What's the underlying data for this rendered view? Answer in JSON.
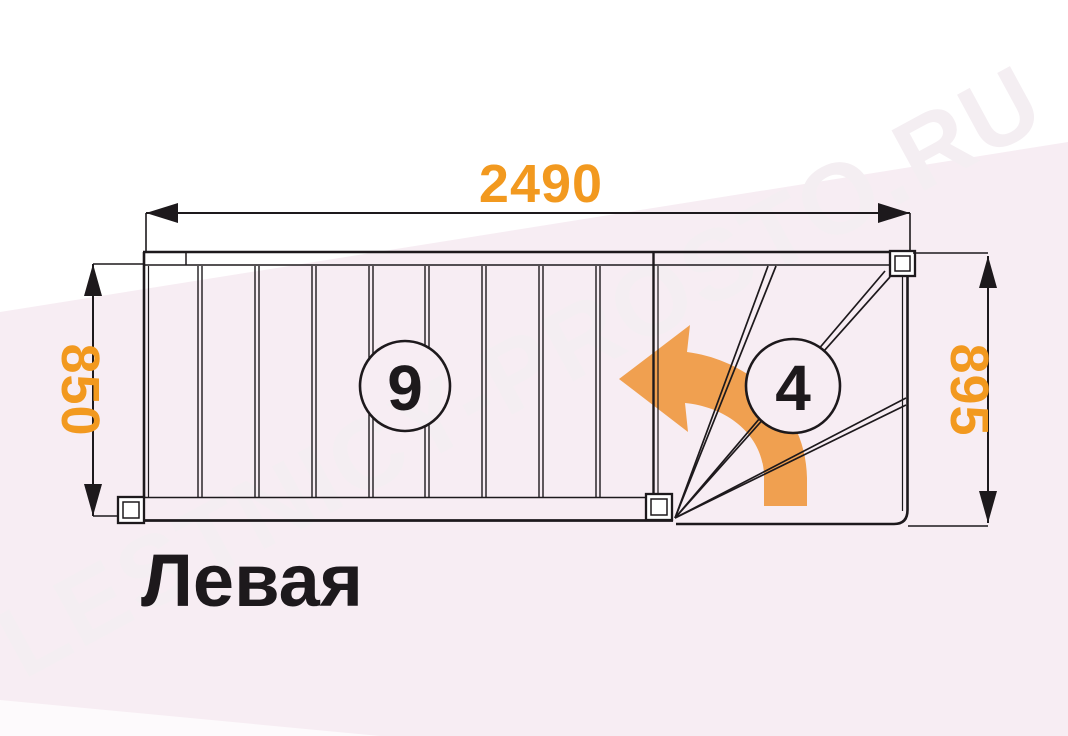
{
  "watermark": {
    "text": "LESTNICY-PROSTO.RU"
  },
  "staircase": {
    "type_label": "Левая",
    "straight_flight_steps": "9",
    "winder_steps": "4",
    "dimensions": {
      "total_length_mm": "2490",
      "flight_width_mm": "850",
      "winder_width_mm": "895"
    }
  },
  "colors": {
    "dimension_text": "#F2991F",
    "turn_arrow": "#F0A050",
    "drawing_lines": "#1D191C",
    "background_pink": "#F7EDF3",
    "background_white_band": "#FFFFFF",
    "watermark_text": "#F4EEF2"
  }
}
